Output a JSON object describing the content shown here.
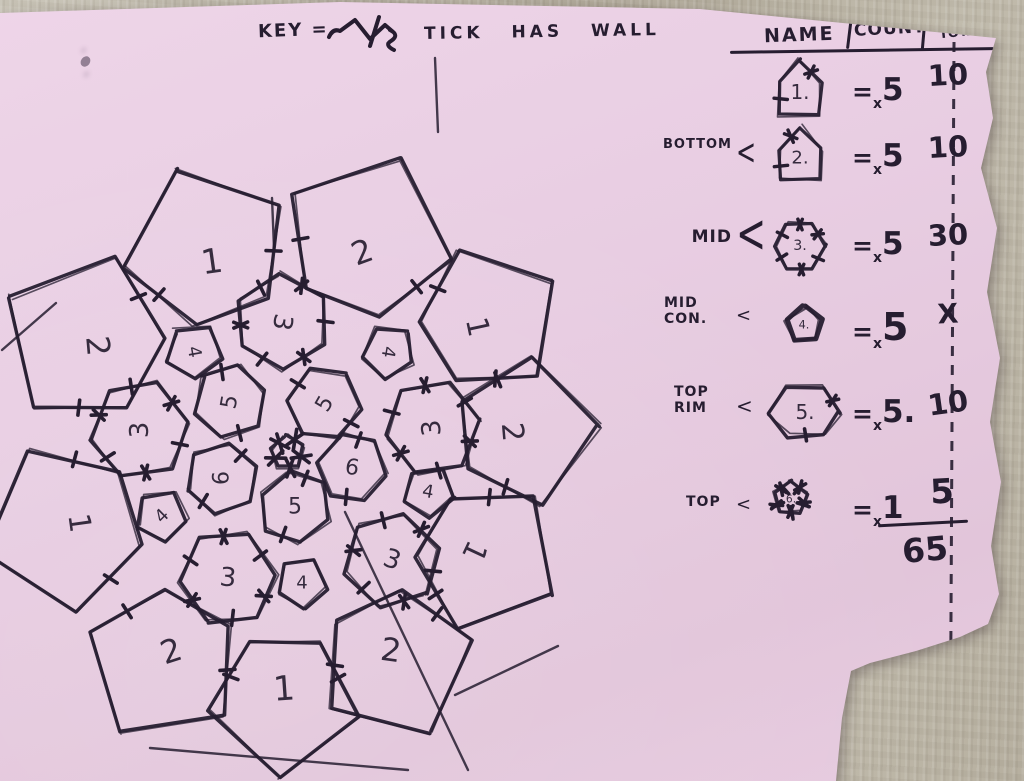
{
  "colors": {
    "ink": "#261d30",
    "paper": "#e8cde2",
    "desk": "#b8b2a3"
  },
  "key": {
    "label": "KEY =",
    "icon": "zigzag-tick-icon",
    "text": "TICK HAS WALL"
  },
  "table": {
    "col_name": "NAME",
    "col_count": "COUNT",
    "col_total_1": "WALLS",
    "col_total_2": "TOTAL",
    "rows": [
      {
        "group": "",
        "bracket": "",
        "eq": "=",
        "x": "x",
        "count": "5",
        "total": "10",
        "glyph": {
          "t": "house",
          "r": 31,
          "label": "1.",
          "ls": 21,
          "cross": [
            0
          ],
          "plus": [
            3
          ],
          "tl": 14
        }
      },
      {
        "group": "BOTTOM",
        "bracket": "<",
        "eq": "=",
        "x": "x",
        "count": "5",
        "total": "10",
        "glyph": {
          "t": "house",
          "r": 30,
          "label": "2.",
          "ls": 19,
          "cross": [
            4
          ],
          "plus": [
            3
          ],
          "tl": 14
        }
      },
      {
        "group": "MID",
        "bracket": "<",
        "eq": "=",
        "x": "x",
        "count": "5",
        "total": "30",
        "glyph": {
          "t": "hex",
          "r": 27,
          "rot": 0,
          "label": "3.",
          "ls": 15,
          "cross": [
            1,
            4,
            5
          ],
          "plus": [
            0,
            2,
            3
          ],
          "tl": 12
        }
      },
      {
        "group": "MID\nCON.",
        "bracket": "<",
        "eq": "=",
        "x": "x",
        "count": "5",
        "total": "X",
        "glyph": {
          "t": "pent",
          "r": 19,
          "rot": -90,
          "label": "4.",
          "ls": 12,
          "bold": true,
          "cross": [],
          "plus": [],
          "tl": 10
        }
      },
      {
        "group": "TOP\nRIM",
        "bracket": "<",
        "eq": "=",
        "x": "x",
        "count": "5.",
        "total": "10",
        "glyph": {
          "t": "hex",
          "r": 28,
          "rot": 0,
          "sx": 1.25,
          "label": "5.",
          "ls": 20,
          "cross": [
            5
          ],
          "plus": [
            1
          ],
          "tl": 12
        }
      },
      {
        "group": "TOP",
        "bracket": "<",
        "eq": "=",
        "x": "x",
        "count": "1",
        "total": "5",
        "glyph": {
          "t": "pent",
          "r": 18,
          "rot": -90,
          "label": "6.",
          "ls": 11,
          "cross": [
            0,
            1,
            2,
            3,
            4
          ],
          "plus": [
            0,
            1,
            2,
            3,
            4
          ],
          "tl": 13
        }
      }
    ],
    "grand_total": "65"
  },
  "drawing": {
    "description": "hand-sketched dome floor plan: outer ring of house pieces 1/2, mid ring hexagons 3 and connector pentagons 4, inner ring hexagons 5/6, tiny top pentagon at center; ticks mark walls",
    "shapes": [
      {
        "t": "fan",
        "x": 212,
        "y": 262,
        "r": 88,
        "rot": -111,
        "label": "1",
        "lr": -8,
        "ls": 34,
        "ticks": [
          1,
          3
        ]
      },
      {
        "t": "fan",
        "x": 362,
        "y": 252,
        "r": 90,
        "rot": -68,
        "label": "2",
        "lr": -20,
        "ls": 32,
        "ticks": [
          1,
          3
        ]
      },
      {
        "t": "fan",
        "x": 477,
        "y": 327,
        "r": 78,
        "rot": -32,
        "label": "1",
        "lr": 78,
        "ls": 30,
        "ticks": [
          1,
          3
        ]
      },
      {
        "t": "fan",
        "x": 512,
        "y": 432,
        "r": 78,
        "rot": -4,
        "label": "2",
        "lr": 85,
        "ls": 30,
        "ticks": [
          1,
          3
        ]
      },
      {
        "t": "fan",
        "x": 474,
        "y": 551,
        "r": 80,
        "rot": 29,
        "label": "1",
        "lr": 115,
        "ls": 30,
        "ticks": [
          1,
          3
        ]
      },
      {
        "t": "fan",
        "x": 391,
        "y": 650,
        "r": 82,
        "rot": 64,
        "label": "2",
        "lr": 8,
        "ls": 32,
        "ticks": [
          1,
          3
        ]
      },
      {
        "t": "fan",
        "x": 284,
        "y": 689,
        "r": 80,
        "rot": 92,
        "label": "1",
        "lr": -4,
        "ls": 34,
        "ticks": [
          1,
          3
        ]
      },
      {
        "t": "fan",
        "x": 171,
        "y": 651,
        "r": 85,
        "rot": 122,
        "label": "2",
        "lr": -18,
        "ls": 32,
        "ticks": [
          1,
          3
        ]
      },
      {
        "t": "fan",
        "x": 79,
        "y": 523,
        "r": 88,
        "rot": 163,
        "label": "1",
        "lr": 82,
        "ls": 30,
        "ticks": [
          1,
          3
        ]
      },
      {
        "t": "fan",
        "x": 98,
        "y": 346,
        "r": 90,
        "rot": -151,
        "label": "2",
        "lr": 85,
        "ls": 32,
        "ticks": [
          1,
          3
        ]
      },
      {
        "t": "hex",
        "x": 282,
        "y": 322,
        "r": 48,
        "rot": -92,
        "label": "3",
        "lr": 100,
        "ls": 26,
        "ticks": [
          0,
          1,
          2,
          3,
          4,
          5
        ]
      },
      {
        "t": "hex",
        "x": 140,
        "y": 430,
        "r": 50,
        "rot": 170,
        "label": "3",
        "lr": -90,
        "ls": 26,
        "ticks": [
          0,
          1,
          2,
          3,
          4,
          5
        ]
      },
      {
        "t": "hex",
        "x": 432,
        "y": 428,
        "r": 48,
        "rot": -10,
        "label": "3",
        "lr": -95,
        "ls": 26,
        "ticks": [
          0,
          1,
          2,
          3,
          4,
          5
        ]
      },
      {
        "t": "hex",
        "x": 228,
        "y": 578,
        "r": 48,
        "rot": 115,
        "label": "3",
        "lr": 5,
        "ls": 26,
        "ticks": [
          0,
          1,
          2,
          3,
          4,
          5
        ]
      },
      {
        "t": "hex",
        "x": 392,
        "y": 560,
        "r": 48,
        "rot": 45,
        "label": "3",
        "lr": 20,
        "ls": 26,
        "ticks": [
          0,
          1,
          2,
          3,
          4,
          5
        ]
      },
      {
        "t": "pent",
        "x": 194,
        "y": 352,
        "r": 28,
        "rot": -132,
        "label": "4",
        "lr": 80,
        "ls": 18,
        "ticks": []
      },
      {
        "t": "pent",
        "x": 388,
        "y": 352,
        "r": 27,
        "rot": -46,
        "label": "4",
        "lr": 100,
        "ls": 18,
        "ticks": []
      },
      {
        "t": "pent",
        "x": 428,
        "y": 492,
        "r": 26,
        "rot": 15,
        "label": "4",
        "lr": 10,
        "ls": 18,
        "ticks": []
      },
      {
        "t": "pent",
        "x": 302,
        "y": 583,
        "r": 26,
        "rot": 83,
        "label": "4",
        "lr": 0,
        "ls": 18,
        "ticks": []
      },
      {
        "t": "pent",
        "x": 162,
        "y": 516,
        "r": 26,
        "rot": 154,
        "label": "4",
        "lr": -45,
        "ls": 18,
        "ticks": []
      },
      {
        "t": "hex",
        "x": 230,
        "y": 402,
        "r": 37,
        "rot": -137,
        "label": "5",
        "lr": -80,
        "ls": 22,
        "ticks": [
          0,
          3
        ]
      },
      {
        "t": "hex",
        "x": 325,
        "y": 404,
        "r": 37,
        "rot": -53,
        "label": "5",
        "lr": -60,
        "ls": 22,
        "ticks": [
          1,
          4
        ]
      },
      {
        "t": "hex",
        "x": 352,
        "y": 468,
        "r": 35,
        "rot": 11,
        "label": "6",
        "lr": 10,
        "ls": 22,
        "ticks": [
          1,
          4
        ]
      },
      {
        "t": "hex",
        "x": 295,
        "y": 507,
        "r": 36,
        "rot": 81,
        "label": "5",
        "lr": 0,
        "ls": 22,
        "ticks": [
          0,
          3
        ]
      },
      {
        "t": "hex",
        "x": 222,
        "y": 478,
        "r": 36,
        "rot": 160,
        "label": "6",
        "lr": -90,
        "ls": 22,
        "ticks": [
          2,
          5
        ]
      },
      {
        "t": "pent",
        "x": 287,
        "y": 453,
        "r": 17,
        "rot": -95,
        "label": "",
        "lr": 0,
        "ls": 10,
        "ticks": [
          0,
          1,
          2,
          3,
          4
        ],
        "tl": 20
      }
    ],
    "strays": [
      [
        435,
        58,
        438,
        132
      ],
      [
        272,
        198,
        274,
        248
      ],
      [
        345,
        512,
        468,
        770
      ],
      [
        150,
        748,
        408,
        770
      ],
      [
        455,
        695,
        558,
        646
      ],
      [
        2,
        350,
        56,
        303
      ]
    ]
  }
}
